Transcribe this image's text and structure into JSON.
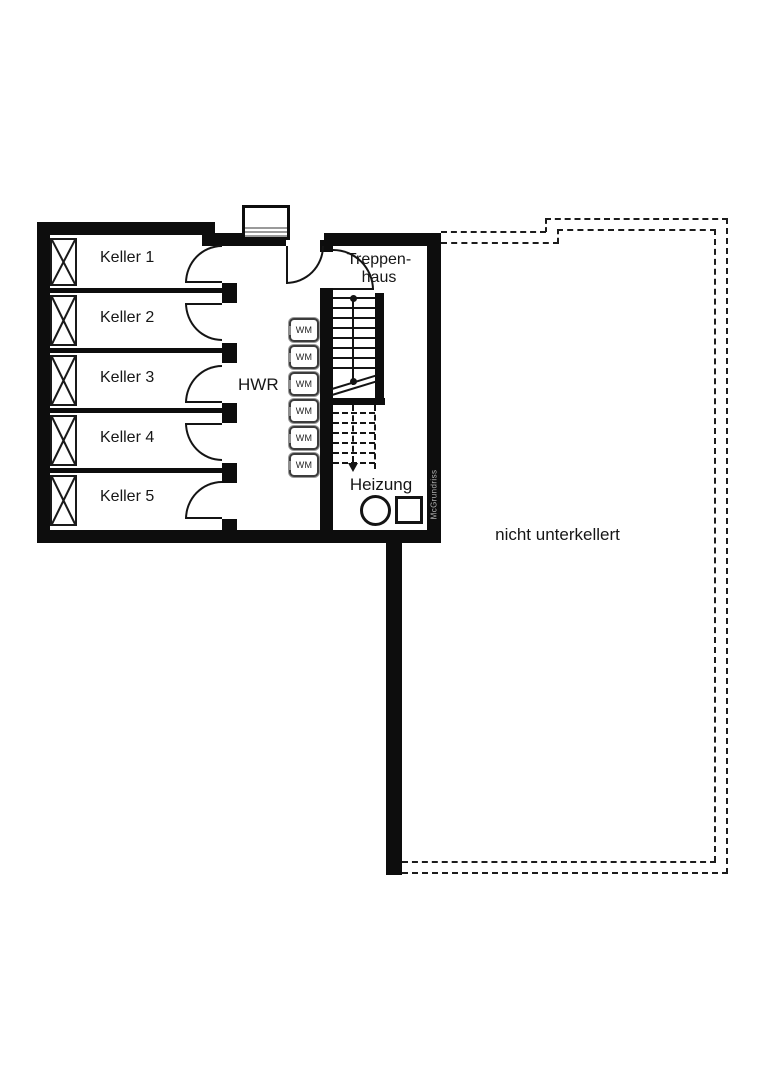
{
  "rooms": {
    "keller": [
      "Keller 1",
      "Keller 2",
      "Keller 3",
      "Keller 4",
      "Keller 5"
    ],
    "hwr": "HWR",
    "treppenhaus": [
      "Treppen-",
      "haus"
    ],
    "heizung": "Heizung"
  },
  "labels": {
    "nicht_unterkellert": "nicht unterkellert",
    "washing_machine": "WM",
    "watermark": "McGrundriss"
  },
  "symbols": {
    "window_box": "crossed-box-window",
    "door_arc": "quarter-circle-door-swing",
    "boiler": "circle",
    "tank": "square",
    "stairs_direction": "arrow-down"
  },
  "colors": {
    "wall": "#0d0d0d",
    "background": "#ffffff",
    "step_gray": "#9a9a9a",
    "watermark_gray": "#b2b2b2"
  }
}
